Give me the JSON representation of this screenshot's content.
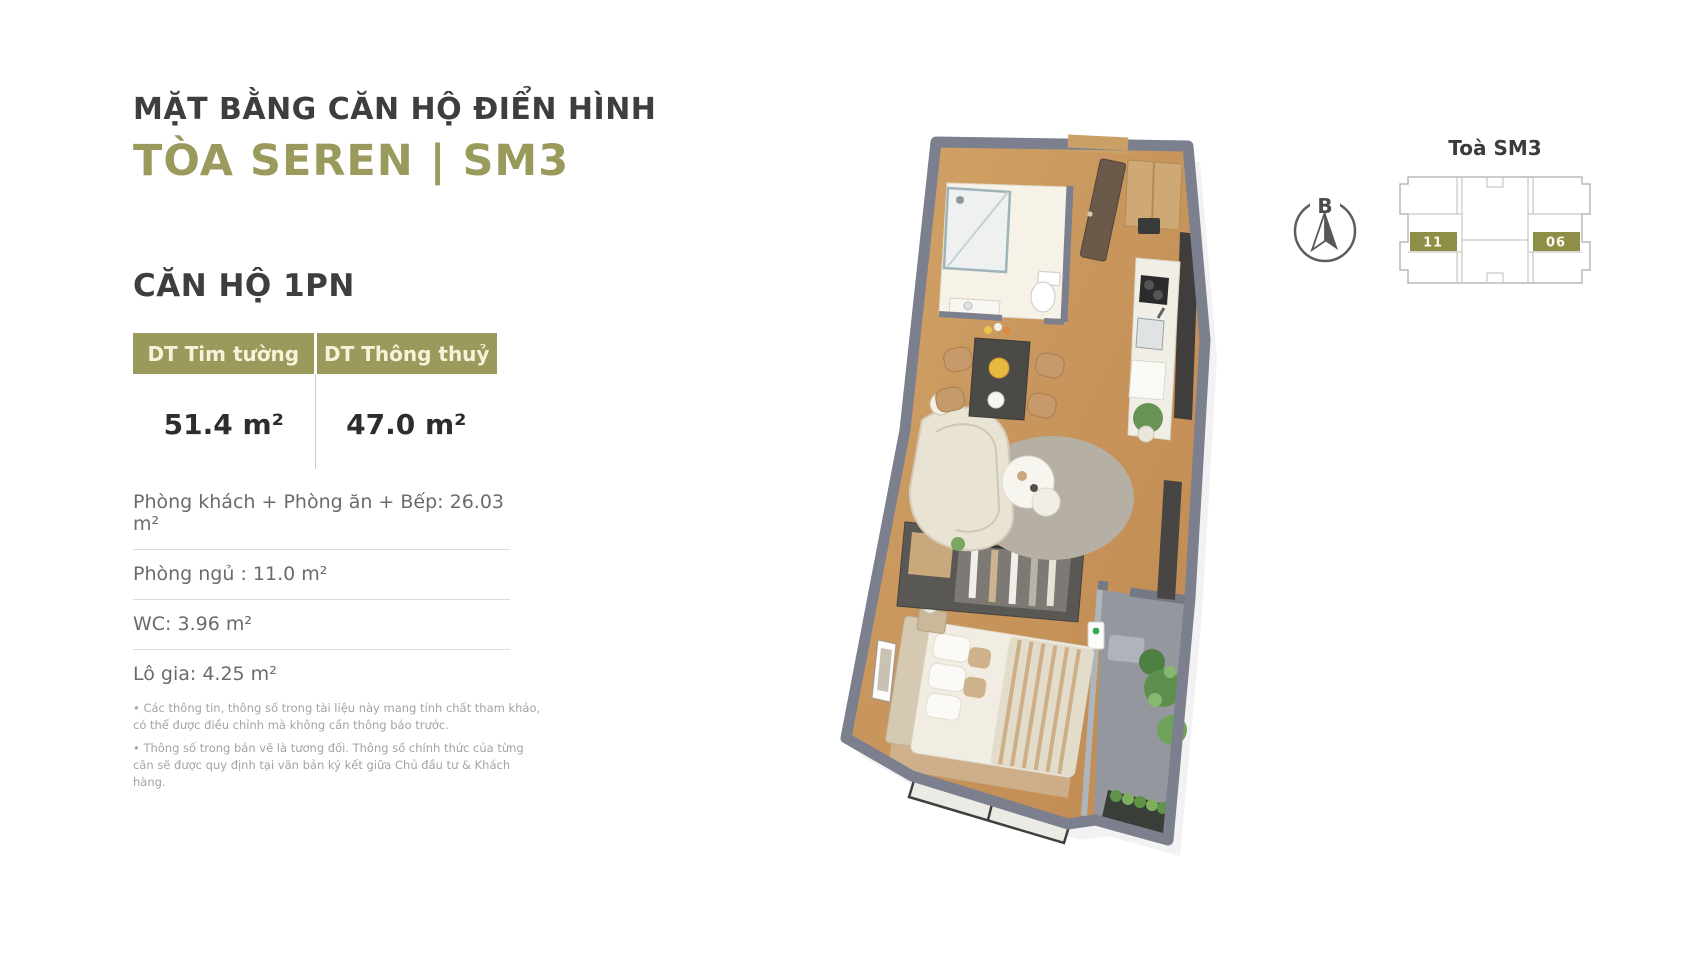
{
  "header": {
    "title_line1": "MẶT BẰNG CĂN HỘ ĐIỂN HÌNH",
    "title_line2": "TÒA SEREN | SM3"
  },
  "apartment": {
    "type_heading": "CĂN HỘ 1PN",
    "area_table": {
      "columns": [
        "DT Tim tường",
        "DT Thông thuỷ"
      ],
      "values": [
        "51.4 m²",
        "47.0 m²"
      ]
    },
    "rooms": [
      "Phòng khách + Phòng ăn + Bếp: 26.03 m²",
      "Phòng ngủ : 11.0 m²",
      "WC: 3.96 m²",
      "Lô gia: 4.25 m²"
    ],
    "notes": [
      "• Các thông tin, thông số trong tài liệu này mang tính chất tham khảo, có thể được điều chỉnh mà không cần thông báo trước.",
      "• Thông số trong bản vẽ là tương đối. Thông số chính thức của từng căn sẽ được quy định tại văn bản ký kết giữa Chủ đầu tư & Khách hàng."
    ]
  },
  "compass": {
    "north_label": "B"
  },
  "keyplan": {
    "title": "Toà SM3",
    "highlighted_units": [
      {
        "label": "11"
      },
      {
        "label": "06"
      }
    ]
  },
  "colors": {
    "accent_olive": "#9A9A5C",
    "title_dark": "#3E3E3E",
    "wall_gray": "#7C808E",
    "wood_floor": "#C99A62",
    "balcony_gray": "#94979E"
  }
}
